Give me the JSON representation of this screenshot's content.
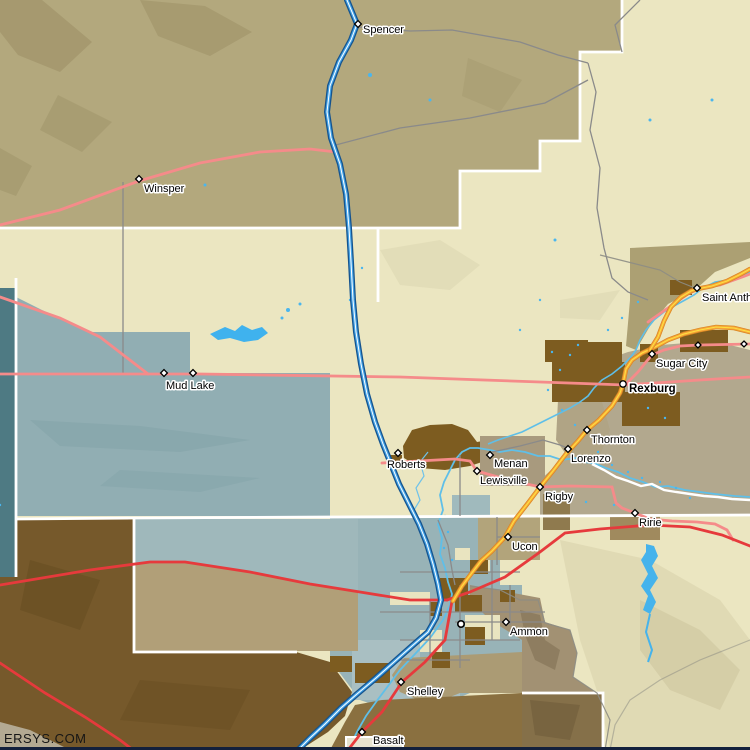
{
  "map": {
    "watermark": "ERSYS.COM",
    "cities": [
      {
        "name": "Spencer",
        "x": 358,
        "y": 24,
        "marker": "diamond",
        "label_x": 363,
        "label_y": 33,
        "bold": false
      },
      {
        "name": "Winsper",
        "x": 139,
        "y": 179,
        "marker": "diamond",
        "label_x": 144,
        "label_y": 192,
        "bold": false
      },
      {
        "name": "Mud Lake",
        "x": 164,
        "y": 373,
        "marker": "diamond",
        "label_x": 166,
        "label_y": 389,
        "bold": false
      },
      {
        "name": "",
        "x": 193,
        "y": 373,
        "marker": "diamond",
        "label_x": 0,
        "label_y": 0,
        "bold": false
      },
      {
        "name": "Saint Anthony",
        "x": 697,
        "y": 288,
        "marker": "diamond",
        "label_x": 702,
        "label_y": 301,
        "bold": false
      },
      {
        "name": "Sugar City",
        "x": 652,
        "y": 354,
        "marker": "diamond",
        "label_x": 656,
        "label_y": 367,
        "bold": false
      },
      {
        "name": "Rexburg",
        "x": 623,
        "y": 384,
        "marker": "circle",
        "label_x": 629,
        "label_y": 392,
        "bold": true
      },
      {
        "name": "Thornton",
        "x": 587,
        "y": 430,
        "marker": "diamond",
        "label_x": 591,
        "label_y": 443,
        "bold": false
      },
      {
        "name": "Lorenzo",
        "x": 568,
        "y": 449,
        "marker": "diamond",
        "label_x": 571,
        "label_y": 462,
        "bold": false
      },
      {
        "name": "Menan",
        "x": 490,
        "y": 455,
        "marker": "diamond",
        "label_x": 494,
        "label_y": 467,
        "bold": false
      },
      {
        "name": "Roberts",
        "x": 398,
        "y": 453,
        "marker": "diamond",
        "label_x": 387,
        "label_y": 468,
        "bold": false
      },
      {
        "name": "Lewisville",
        "x": 477,
        "y": 471,
        "marker": "diamond",
        "label_x": 480,
        "label_y": 484,
        "bold": false
      },
      {
        "name": "Rigby",
        "x": 540,
        "y": 487,
        "marker": "diamond",
        "label_x": 545,
        "label_y": 500,
        "bold": false
      },
      {
        "name": "Ririe",
        "x": 635,
        "y": 513,
        "marker": "diamond",
        "label_x": 639,
        "label_y": 526,
        "bold": false
      },
      {
        "name": "Ucon",
        "x": 508,
        "y": 537,
        "marker": "diamond",
        "label_x": 512,
        "label_y": 550,
        "bold": false
      },
      {
        "name": "Ammon",
        "x": 506,
        "y": 622,
        "marker": "diamond",
        "label_x": 510,
        "label_y": 635,
        "bold": false
      },
      {
        "name": "Shelley",
        "x": 401,
        "y": 682,
        "marker": "diamond",
        "label_x": 407,
        "label_y": 695,
        "bold": false
      },
      {
        "name": "Basalt",
        "x": 362,
        "y": 732,
        "marker": "diamond",
        "label_x": 373,
        "label_y": 744,
        "bold": false
      },
      {
        "name": "",
        "x": 461,
        "y": 624,
        "marker": "circle",
        "label_x": 0,
        "label_y": 0,
        "bold": false
      }
    ],
    "unnamed_markers": [
      [
        698,
        345
      ],
      [
        744,
        344
      ]
    ],
    "colors": {
      "terrain_cream": "#ebe6c1",
      "terrain_tan": "#b3a87d",
      "terrain_gray_tan": "#b2a88e",
      "wetland_blue_gray": "#91aeb3",
      "dark_teal": "#4e7a83",
      "dark_brown_lava": "#76592b",
      "urban_brown": "#7d5c20",
      "water": "#45b3ec",
      "interstate": "#44a3e6",
      "interstate_casing": "#15538e",
      "us_highway_orange": "#f6a53b",
      "us_highway_yellow_stripe": "#ffe23e",
      "highway_red": "#e63a3c",
      "state_highway_pink": "#f58b8a",
      "minor_road_gray": "#8a8a8a",
      "county_boundary": "#ffffff",
      "label_text": "#000000"
    }
  }
}
